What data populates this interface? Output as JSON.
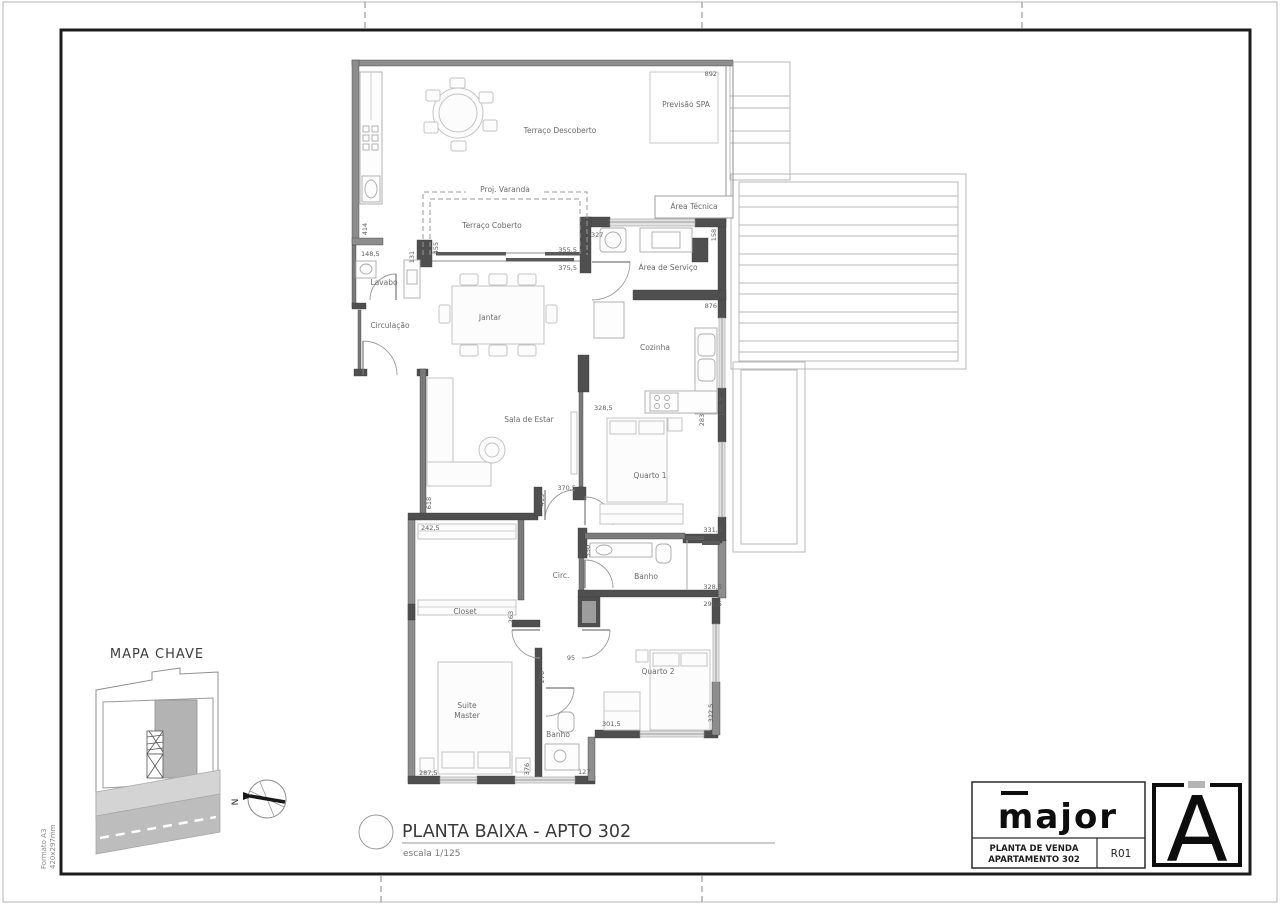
{
  "sheet": {
    "format_line1": "Formato A3",
    "format_line2": "420x297mm"
  },
  "plan": {
    "title": "PLANTA BAIXA - APTO 302",
    "scale": "escala 1/125",
    "rooms": {
      "previsao_spa": "Previsão SPA",
      "terraco_descoberto": "Terraço Descoberto",
      "proj_varanda": "Proj. Varanda",
      "terraco_coberto": "Terraço Coberto",
      "area_tecnica": "Área Técnica",
      "area_servico": "Área de Serviço",
      "lavabo": "Lavabo",
      "circulacao": "Circulação",
      "jantar": "Jantar",
      "cozinha": "Cozinha",
      "sala": "Sala de Estar",
      "quarto1": "Quarto 1",
      "banho": "Banho",
      "circ": "Circ.",
      "closet": "Closet",
      "quarto2": "Quarto 2",
      "suite_line1": "Suite",
      "suite_line2": "Master",
      "banho_suite": "Banho"
    },
    "dims": {
      "d892": "892",
      "d414": "414",
      "d148_5": "148,5",
      "d131": "131",
      "d455": "455",
      "d355_5": "355,5",
      "d375_5": "375,5",
      "d327": "327",
      "d158": "158",
      "d876": "876",
      "d328_5_coz": "328,5",
      "d283": "283",
      "d166_5": "166,5",
      "d370_5": "370,5",
      "d618": "618",
      "d242_5": "242,5",
      "d415": "415",
      "d330": "330",
      "d331_5": "331,5",
      "d328_5_banho": "328,5",
      "d291_5": "291,5",
      "d263": "263",
      "d95": "95",
      "d270": "270",
      "d301_5": "301,5",
      "d322_5": "322,5",
      "d287_5": "287,5",
      "d376": "376",
      "d127": "127"
    }
  },
  "key_map": {
    "title": "MAPA CHAVE",
    "north_label": "N"
  },
  "title_block": {
    "logo": "major",
    "doc_line1": "PLANTA DE VENDA",
    "doc_line2": "APARTAMENTO 302",
    "revision": "R01",
    "mark": "A"
  },
  "colors": {
    "wall_dark": "#4f4f4f",
    "wall_gray": "#8d8d8d",
    "unit_highlight": "#b3b3b3",
    "road": "#bdbdbd",
    "ink": "#111111"
  }
}
